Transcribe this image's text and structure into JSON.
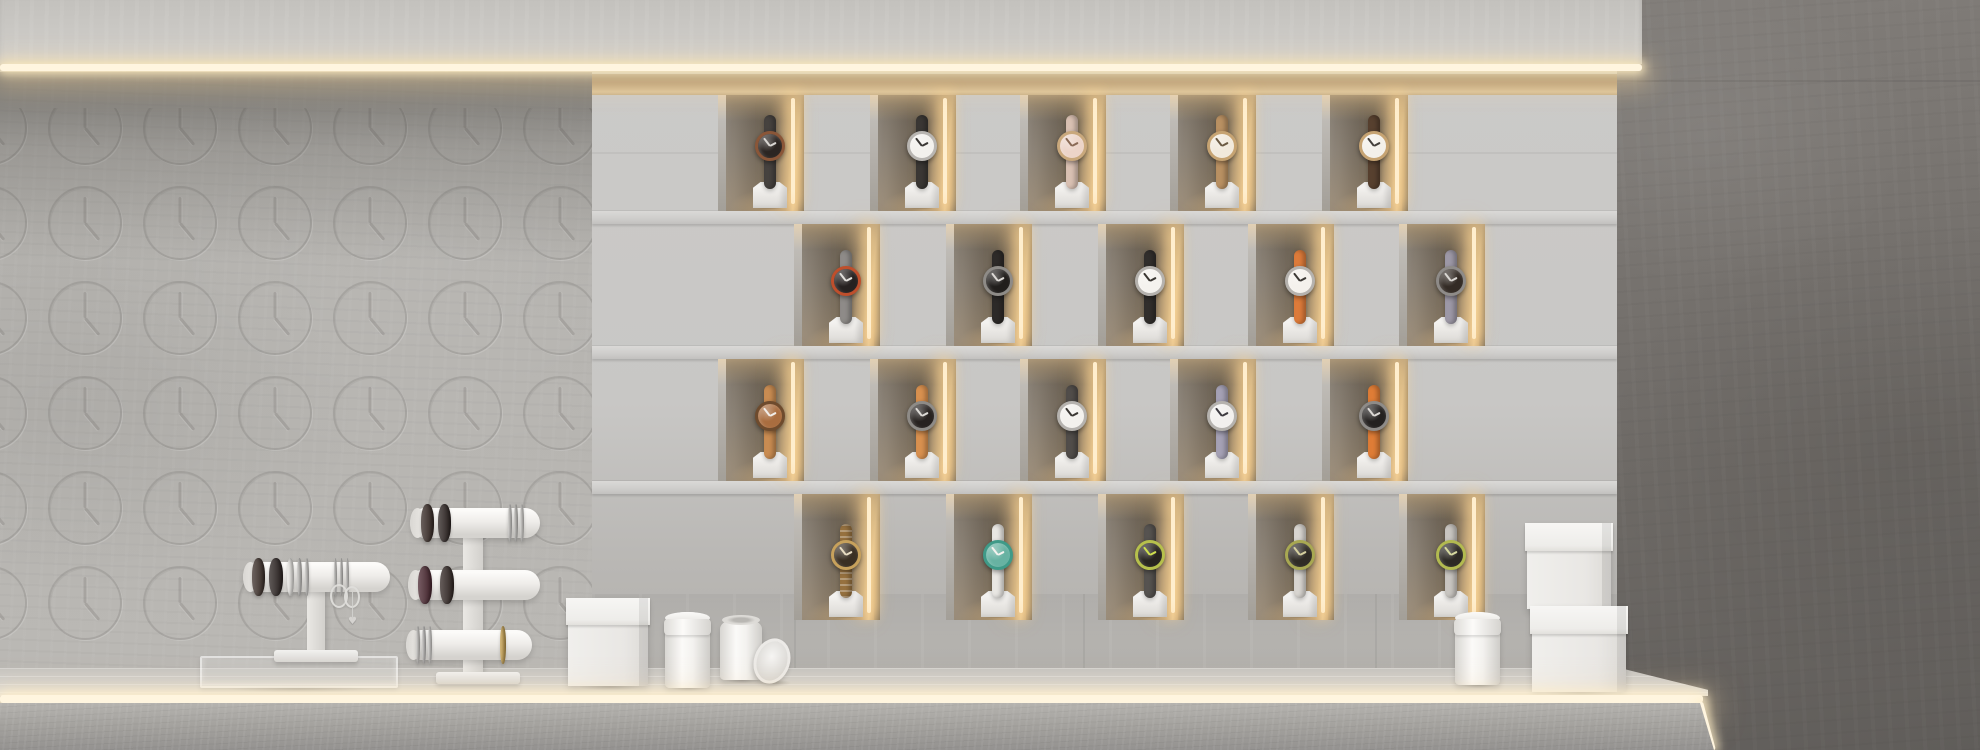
{
  "palette": {
    "left_wall": "#b2b0ac",
    "display_wall": "#c8c7c5",
    "right_wall": "#6e6a66",
    "soffit": "#cbc9c5",
    "led": "#fff5df",
    "niche_interior_dark": "#6e6456",
    "niche_warm_glow": "#e2c696",
    "pedestal_white": "#f1f0ee",
    "counter_top": "#d3d1cd",
    "counter_face": "#a5a39f"
  },
  "clock_pattern": {
    "start_x": -10,
    "spacing_x": 95,
    "cols": 7,
    "start_y": 20,
    "spacing_y": 95,
    "rows": 6,
    "diameter": 74,
    "minute_hand_deg": 0,
    "hour_hand_deg": 140,
    "minute_len": 26,
    "hour_len": 22
  },
  "display_wall": {
    "x": 592,
    "top": 74,
    "width": 1025,
    "niche_width": 86,
    "niche_center_offset": 52,
    "shelves_y": [
      211,
      346,
      481
    ],
    "rows": [
      {
        "top": 95,
        "height": 116,
        "watch_xs": [
          770,
          922,
          1072,
          1222,
          1374
        ],
        "watches": [
          {
            "face": "#2b2522",
            "bezel": "#8a5638",
            "strap": "#46423f",
            "hands": "#d9d6d2",
            "links": false
          },
          {
            "face": "#f3f1ed",
            "bezel": "#b8b5b1",
            "strap": "#3a3734",
            "hands": "#3a3734",
            "links": false
          },
          {
            "face": "#ecd4c8",
            "bezel": "#c9a87c",
            "strap": "#d9c0b2",
            "hands": "#8a6a55",
            "links": false
          },
          {
            "face": "#f1e9dc",
            "bezel": "#c6a372",
            "strap": "#b99062",
            "hands": "#6b5a43",
            "links": false
          },
          {
            "face": "#f3f0ea",
            "bezel": "#c6a372",
            "strap": "#57402f",
            "hands": "#44403c",
            "links": false
          }
        ]
      },
      {
        "top": 224,
        "height": 122,
        "watch_xs": [
          846,
          998,
          1150,
          1300,
          1451
        ],
        "watches": [
          {
            "face": "#262120",
            "bezel": "#bf4f2c",
            "strap": "#8e8b88",
            "hands": "#e2dfdb",
            "links": false
          },
          {
            "face": "#211e1c",
            "bezel": "#8e8b87",
            "strap": "#2d2a28",
            "hands": "#dcd9d5",
            "links": false
          },
          {
            "face": "#f4f2ee",
            "bezel": "#b5b2ae",
            "strap": "#312e2c",
            "hands": "#3a3733",
            "links": false
          },
          {
            "face": "#f4f1ec",
            "bezel": "#b5b2ae",
            "strap": "#dd7b3a",
            "hands": "#3d3a36",
            "links": false
          },
          {
            "face": "#332b25",
            "bezel": "#8e8b88",
            "strap": "#9d98a6",
            "hands": "#d9d6d2",
            "links": false
          }
        ]
      },
      {
        "top": 359,
        "height": 122,
        "watch_xs": [
          770,
          922,
          1072,
          1222,
          1374
        ],
        "watches": [
          {
            "face": "#a96d3f",
            "bezel": "#6e4b2d",
            "strap": "#c98c52",
            "hands": "#f1ede8",
            "links": false
          },
          {
            "face": "#272220",
            "bezel": "#8e8b87",
            "strap": "#d8904f",
            "hands": "#dcd9d5",
            "links": false
          },
          {
            "face": "#f3f1ed",
            "bezel": "#b5b2ae",
            "strap": "#514d4a",
            "hands": "#3a3733",
            "links": false
          },
          {
            "face": "#f2f0ee",
            "bezel": "#b5b2ae",
            "strap": "#a5a1b5",
            "hands": "#3d3a40",
            "links": false
          },
          {
            "face": "#242120",
            "bezel": "#8e8b88",
            "strap": "#de7c36",
            "hands": "#dcd9d5",
            "links": false
          }
        ]
      },
      {
        "top": 494,
        "height": 126,
        "watch_xs": [
          846,
          998,
          1150,
          1300,
          1451
        ],
        "watches": [
          {
            "face": "#3a2f23",
            "bezel": "#c7a15c",
            "strap": "#96713f",
            "hands": "#e8dcc2",
            "links": true
          },
          {
            "face": "#67b2a2",
            "bezel": "#3f9a88",
            "strap": "#e9e7e3",
            "hands": "#f4f2ee",
            "links": false
          },
          {
            "face": "#272420",
            "bezel": "#b6c04c",
            "strap": "#565350",
            "hands": "#cfe04e",
            "links": false
          },
          {
            "face": "#2f2b25",
            "bezel": "#a8a852",
            "strap": "#d8d5d0",
            "hands": "#d5cf9e",
            "links": false
          },
          {
            "face": "#2c2924",
            "bezel": "#b2ba50",
            "strap": "#c8c5c0",
            "hands": "#d5d89e",
            "links": false
          }
        ]
      }
    ],
    "lower_seams_x": [
      202,
      491,
      783
    ]
  },
  "counter_items": {
    "acrylic_tray": {
      "x": 200,
      "y": 656,
      "w": 198,
      "h": 32
    },
    "single_tier_stand": {
      "bar": {
        "x": 243,
        "y": 562,
        "w": 147,
        "h": 30
      },
      "post": {
        "x": 307,
        "y": 588,
        "w": 18,
        "h": 66
      },
      "foot": {
        "x": 274,
        "y": 650,
        "w": 84,
        "h": 12
      },
      "bands": [
        {
          "x": 252,
          "w": 13,
          "color": "#3d302a"
        },
        {
          "x": 269,
          "w": 14,
          "color": "#2c2422"
        },
        {
          "x": 287,
          "w": 7,
          "color": "#eceae6"
        },
        {
          "x": 297,
          "w": 5,
          "color": "#cbc9c6"
        },
        {
          "x": 305,
          "w": 4,
          "color": "#d6d4d1"
        },
        {
          "x": 334,
          "w": 3,
          "color": "#d9d7d4"
        },
        {
          "x": 340,
          "w": 3,
          "color": "#cfcdca"
        },
        {
          "x": 346,
          "w": 3,
          "color": "#dbd9d6"
        }
      ],
      "hang_rings": [
        {
          "x": 330,
          "y": 584,
          "w": 18,
          "h": 24
        },
        {
          "x": 344,
          "y": 586,
          "w": 16,
          "h": 22
        }
      ],
      "charm": {
        "line_x": 352,
        "line_y": 592,
        "line_h": 26,
        "heart_x": 348,
        "heart_y": 616
      }
    },
    "triple_tier_stand": {
      "post": {
        "x": 463,
        "y": 520,
        "w": 20,
        "h": 152
      },
      "foot": {
        "x": 436,
        "y": 672,
        "w": 84,
        "h": 12
      },
      "tiers": [
        {
          "bar": {
            "x": 410,
            "y": 508,
            "w": 130,
            "h": 30
          },
          "bands": [
            {
              "x": 421,
              "w": 13,
              "color": "#382b26"
            },
            {
              "x": 438,
              "w": 13,
              "color": "#2e2523"
            },
            {
              "x": 508,
              "w": 4,
              "color": "#d8d6d3"
            },
            {
              "x": 514,
              "w": 4,
              "color": "#cfcdc9"
            },
            {
              "x": 520,
              "w": 4,
              "color": "#dcdad6"
            }
          ]
        },
        {
          "bar": {
            "x": 408,
            "y": 570,
            "w": 132,
            "h": 30
          },
          "bands": [
            {
              "x": 418,
              "w": 14,
              "color": "#4a2730"
            },
            {
              "x": 440,
              "w": 14,
              "color": "#332825"
            }
          ]
        },
        {
          "bar": {
            "x": 406,
            "y": 630,
            "w": 126,
            "h": 30
          },
          "bands": [
            {
              "x": 416,
              "w": 4,
              "color": "#d9d7d4"
            },
            {
              "x": 422,
              "w": 4,
              "color": "#cfcdcb"
            },
            {
              "x": 428,
              "w": 4,
              "color": "#dcdad7"
            },
            {
              "x": 500,
              "w": 6,
              "color": "#c9a24f"
            }
          ]
        }
      ]
    },
    "boxes": [
      {
        "name": "left-gift-box",
        "x": 568,
        "y": 598,
        "w": 80,
        "h": 88,
        "lid_h": 27
      },
      {
        "name": "right-box-top",
        "x": 1527,
        "y": 523,
        "w": 84,
        "h": 86,
        "lid_h": 28
      },
      {
        "name": "right-box-bottom",
        "x": 1532,
        "y": 606,
        "w": 94,
        "h": 86,
        "lid_h": 28
      }
    ],
    "cylinders": [
      {
        "name": "canister-with-lid",
        "x": 665,
        "y": 612,
        "w": 45,
        "h": 76,
        "lid": true
      },
      {
        "name": "canister-open",
        "x": 720,
        "y": 618,
        "w": 42,
        "h": 62,
        "lid": false,
        "open": true
      },
      {
        "name": "right-canister",
        "x": 1455,
        "y": 612,
        "w": 45,
        "h": 73,
        "lid": true
      }
    ],
    "lid_disc": {
      "x": 754,
      "y": 638,
      "w": 36,
      "h": 46,
      "rotate": 18
    }
  }
}
